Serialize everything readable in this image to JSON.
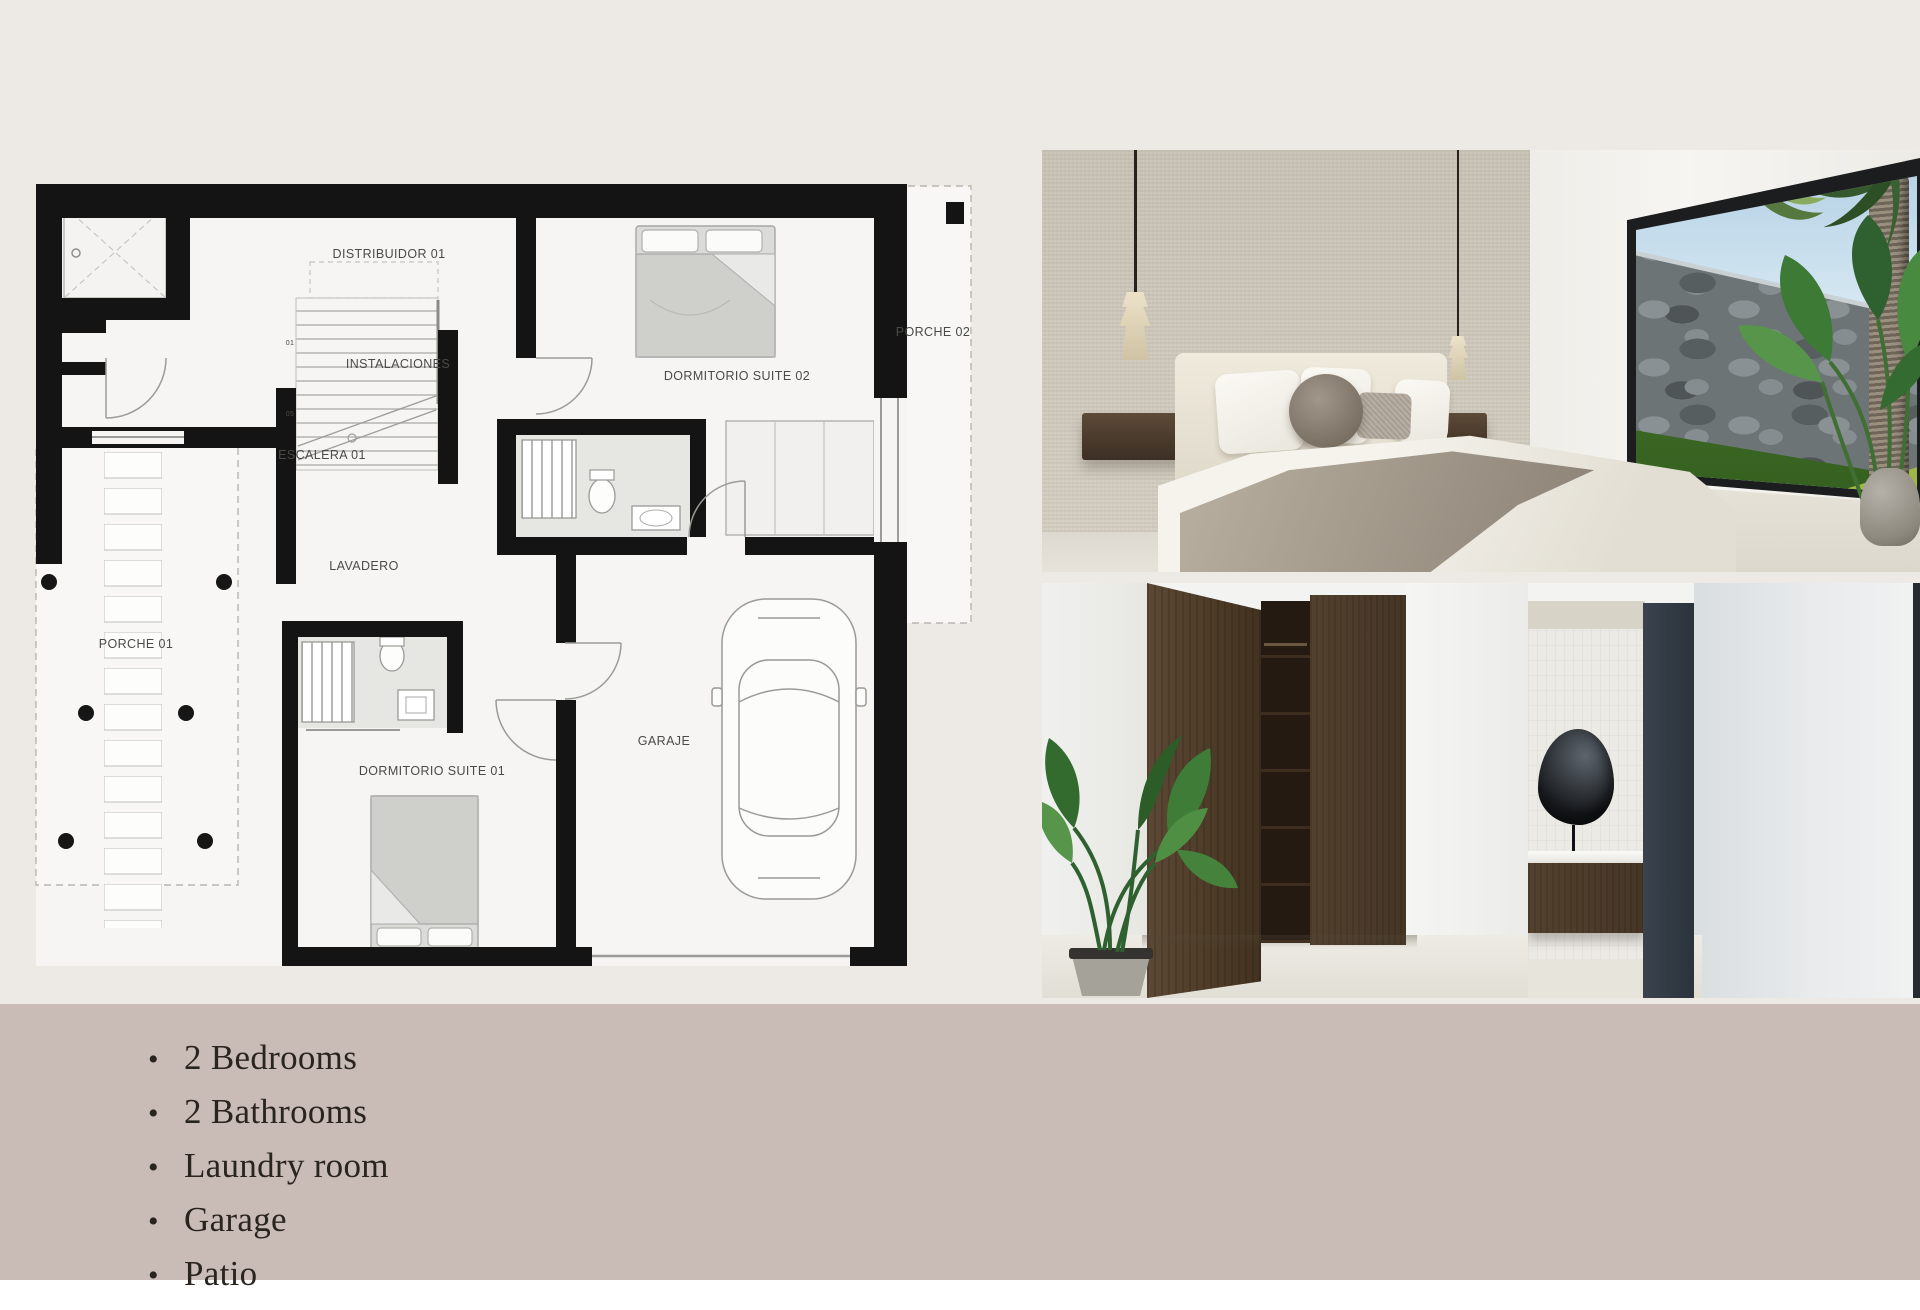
{
  "colors": {
    "background": "#EDE9E5",
    "footer_bar": "#C9BCB6",
    "plan_paper": "#F6F5F3",
    "plan_wall": "#141414",
    "wood_dark": "#4A3728",
    "slate_panel": "#323C46"
  },
  "floor_plan": {
    "rooms": [
      {
        "label": "DISTRIBUIDOR 01"
      },
      {
        "label": "INSTALACIONES"
      },
      {
        "label": "ESCALERA 01"
      },
      {
        "label": "LAVADERO"
      },
      {
        "label": "PORCHE 01"
      },
      {
        "label": "PORCHE 02"
      },
      {
        "label": "DORMITORIO SUITE 02"
      },
      {
        "label": "GARAJE"
      },
      {
        "label": "DORMITORIO SUITE 01"
      }
    ],
    "stair_marks": [
      "01",
      "05"
    ]
  },
  "photos": {
    "top_name": "bedroom-render",
    "bottom_name": "dressing-room-and-bathroom-render"
  },
  "features": {
    "items": [
      "2 Bedrooms",
      "2 Bathrooms",
      "Laundry room",
      "Garage",
      "Patio"
    ]
  }
}
